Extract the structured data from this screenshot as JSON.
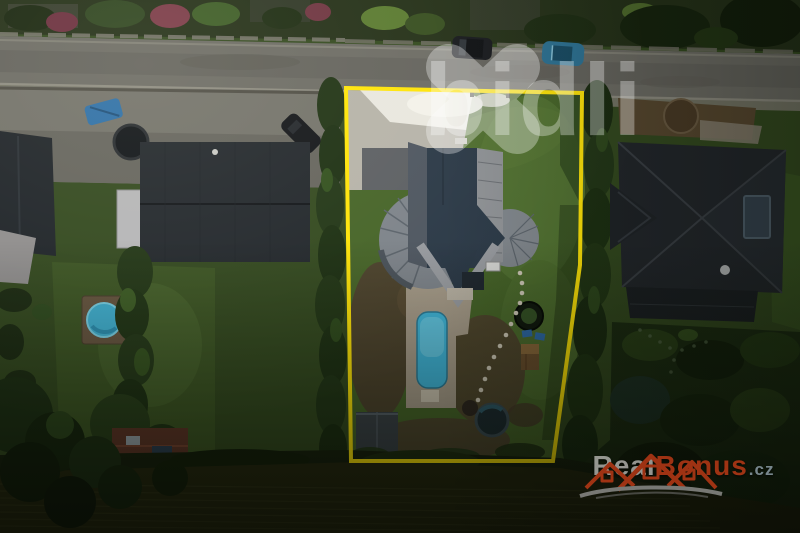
{
  "watermarks": {
    "bidli": {
      "text": "bidli",
      "color": "#ffffff",
      "opacity": "0.32"
    },
    "realbonus": {
      "text_real": "Real",
      "text_bonus": "Bonus",
      "text_tld": ".cz",
      "red": "#bf3a16",
      "gray": "#b3b2ae",
      "swoosh_gray": "#8f8f8d"
    }
  },
  "boundary": {
    "color": "#ffe408"
  },
  "colors": {
    "street": "#6c6b64",
    "sidewalk": "#7b796d",
    "lawn": "#466428",
    "lawn_bright": "#527232",
    "neighbor_lawn": "#3c5523",
    "driveway": "#b6b3a9",
    "driveway_sunlit": "#e9e7df",
    "dirt": "#4e412d",
    "pool_water": "#3fb4d8",
    "pool_small": "#3fb2d4",
    "roof_dark": "#2b3947",
    "roof_gray": "#8f9296",
    "neighbor_roof_left": "#22272c",
    "neighbor_roof_right": "#22262b",
    "shed_roof": "#3a4147",
    "red_shed_roof": "#5f3527",
    "field": "#26280f",
    "hedge": "#203315",
    "car_blue": "#2c7193",
    "car_dark": "#17191d"
  }
}
